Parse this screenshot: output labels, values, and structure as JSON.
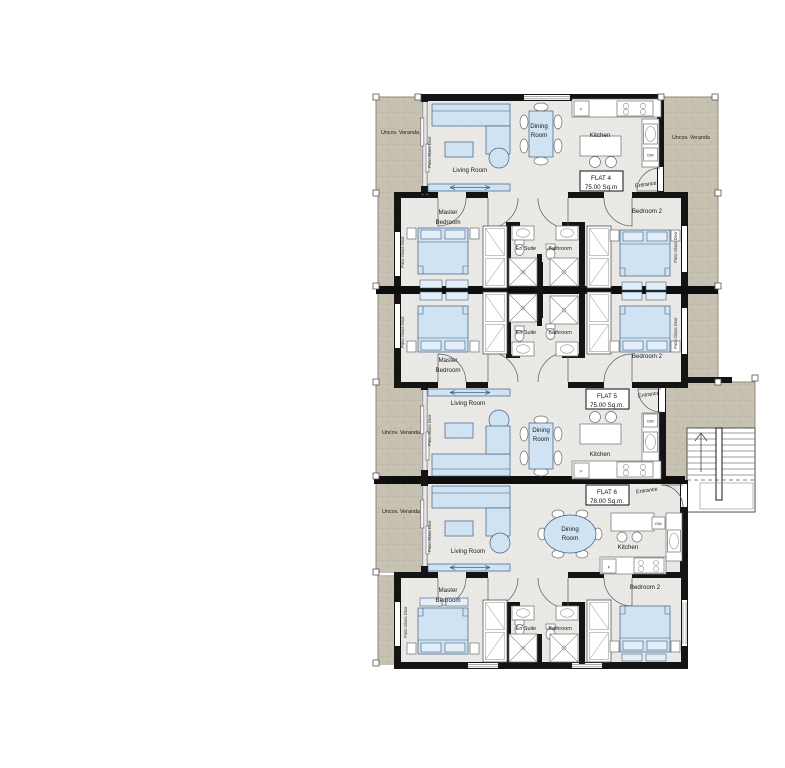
{
  "plan": {
    "flats": [
      {
        "name": "FLAT 4",
        "area": "75.00 Sq.m"
      },
      {
        "name": "FLAT 5",
        "area": "75.00 Sq.m."
      },
      {
        "name": "FLAT 6",
        "area": "78.00 Sq.m."
      }
    ],
    "labels": {
      "uncov_veranda": "Uncov. Veranda",
      "patio_glass_door": "Patio Glass Door",
      "living_room": "Living Room",
      "dining": "Dining",
      "room": "Room",
      "kitchen": "Kitchen",
      "master": "Master",
      "bedroom": "Bedroom",
      "bedroom_2": "Bedroom 2",
      "en_suite": "En Suite",
      "bathroom": "Bathroom",
      "entrance": "Entrance",
      "fridge": "F",
      "dishwasher": "DW"
    },
    "colors": {
      "wall": "#141414",
      "floor": "#eae9e5",
      "veranda": "#c7c1b2",
      "furniture_fill": "#cfe3f3",
      "furniture_stroke": "#3f5f82",
      "text": "#1a1a1a"
    }
  }
}
